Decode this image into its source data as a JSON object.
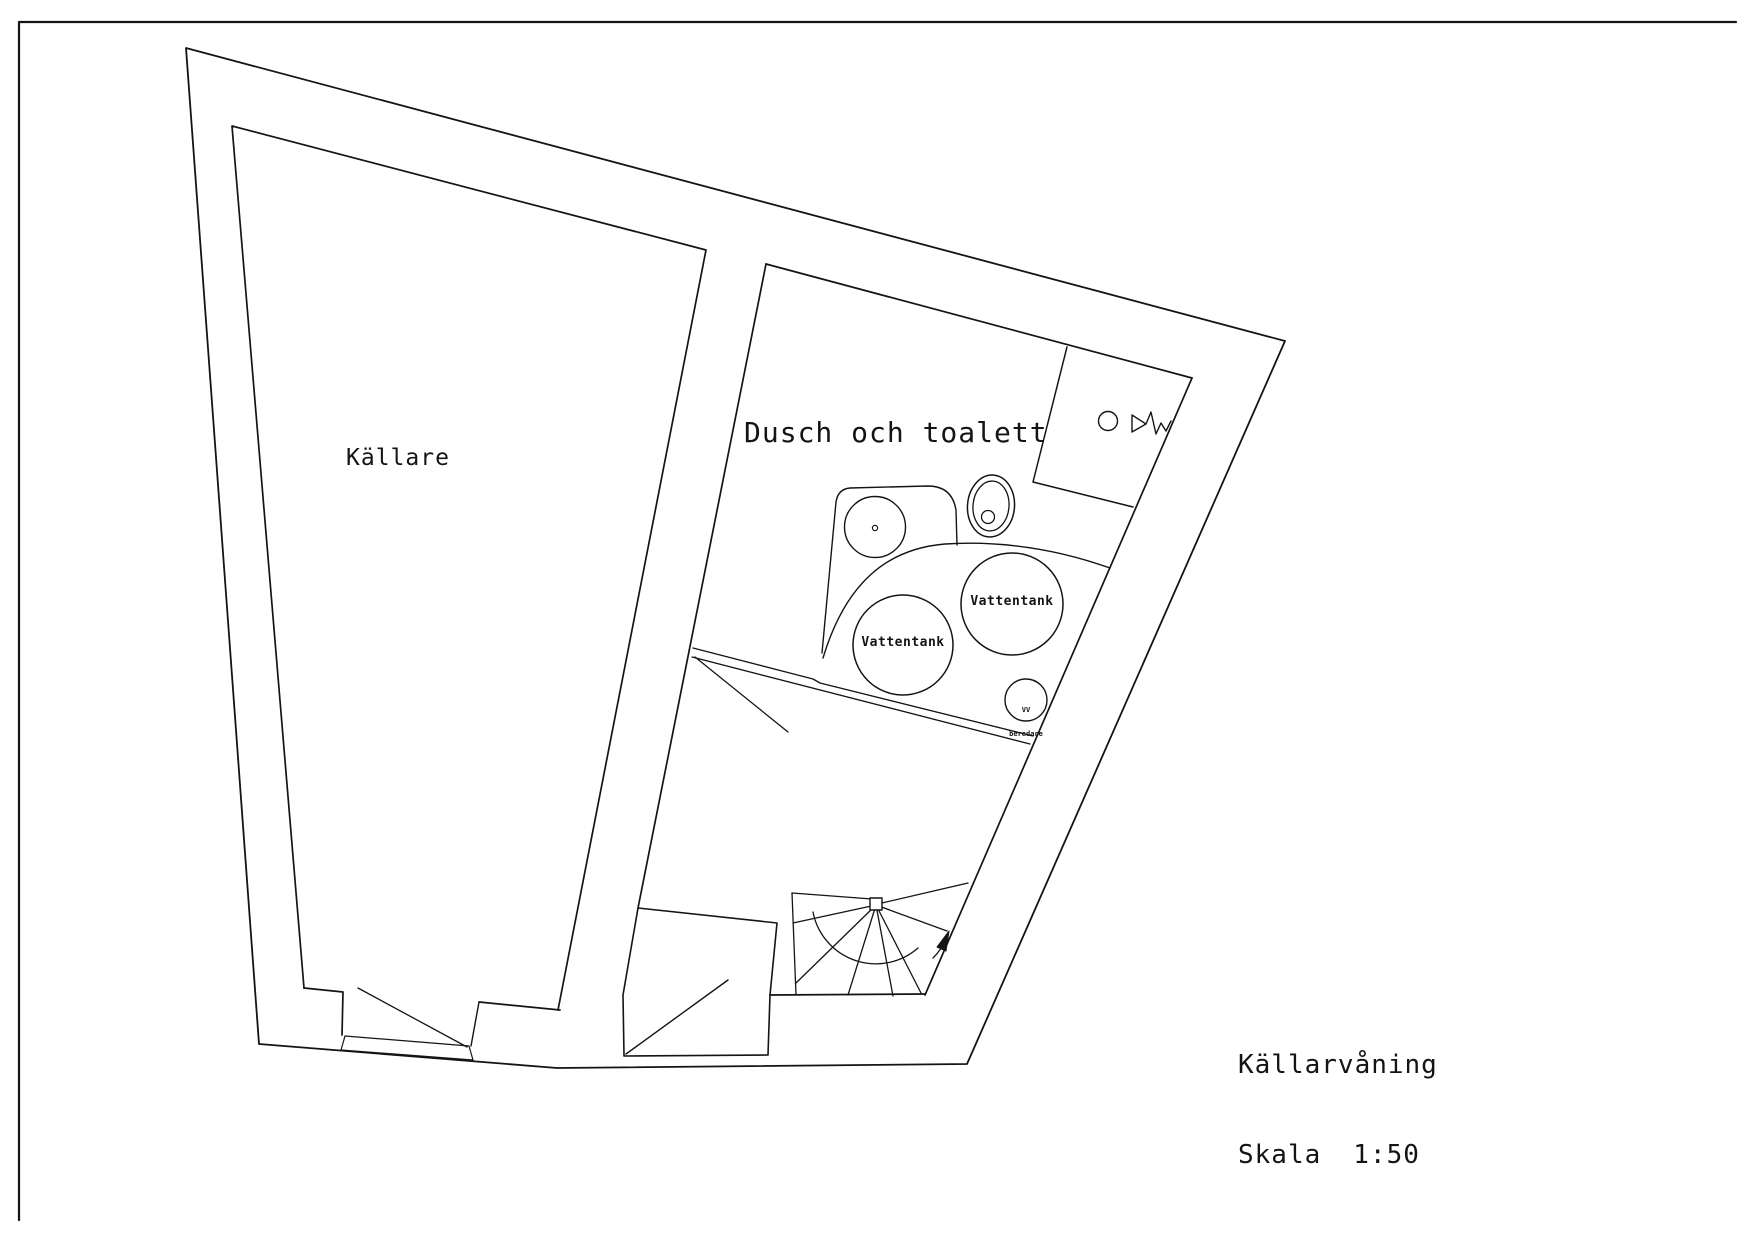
{
  "drawing": {
    "background": "#ffffff",
    "stroke_color": "#141414",
    "rooms": {
      "kallare": {
        "label": "Källare"
      },
      "dusch_och_toalett": {
        "label": "Dusch och toalett"
      }
    },
    "equipment": {
      "vattentank_left": {
        "label": "Vattentank"
      },
      "vattentank_right": {
        "label": "Vattentank"
      },
      "vv_beredare": {
        "label_line1": "VV",
        "label_line2": "beredare"
      }
    },
    "title_block": {
      "project": "Källarvåning",
      "scale_label": "Skala",
      "scale_value": "1:50"
    }
  }
}
